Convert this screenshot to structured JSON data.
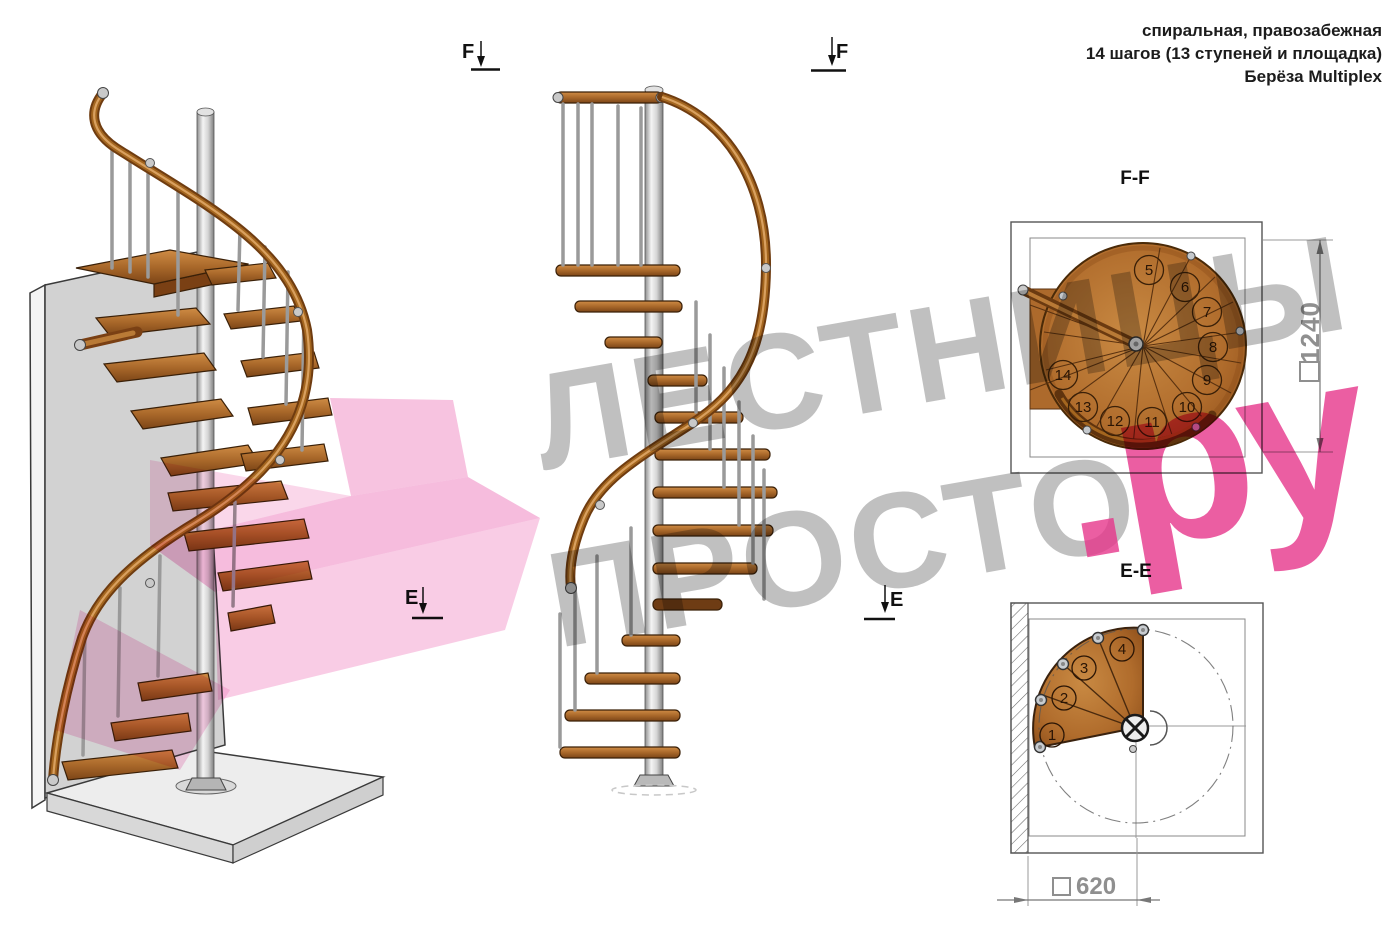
{
  "annotation": {
    "line1": "спиральная, правозабежная",
    "line2": "14 шагов (13 ступеней и площадка)",
    "line3": "Берёза Multiplex"
  },
  "views": {
    "ff_label": "F-F",
    "ee_label": "E-E"
  },
  "section_markers": {
    "f": "F",
    "e": "E"
  },
  "dimensions": {
    "ff_value": "1240",
    "ee_value": "620"
  },
  "ff_plan": {
    "steps": [
      "5",
      "6",
      "7",
      "8",
      "9",
      "10",
      "11",
      "12",
      "13",
      "14"
    ]
  },
  "ee_plan": {
    "steps": [
      "1",
      "2",
      "3",
      "4"
    ]
  },
  "watermark": {
    "line1": "ЛЕСТНИЦЫ",
    "line2_gray": "ПРОСТО",
    "line2_pink": ".ру"
  },
  "colors": {
    "wood": "#b4702c",
    "handrail": "#8a4a1a",
    "metal": "#c9c9c9",
    "watermark_gray": "#8a8a8a",
    "watermark_pink": "#e6368b"
  }
}
